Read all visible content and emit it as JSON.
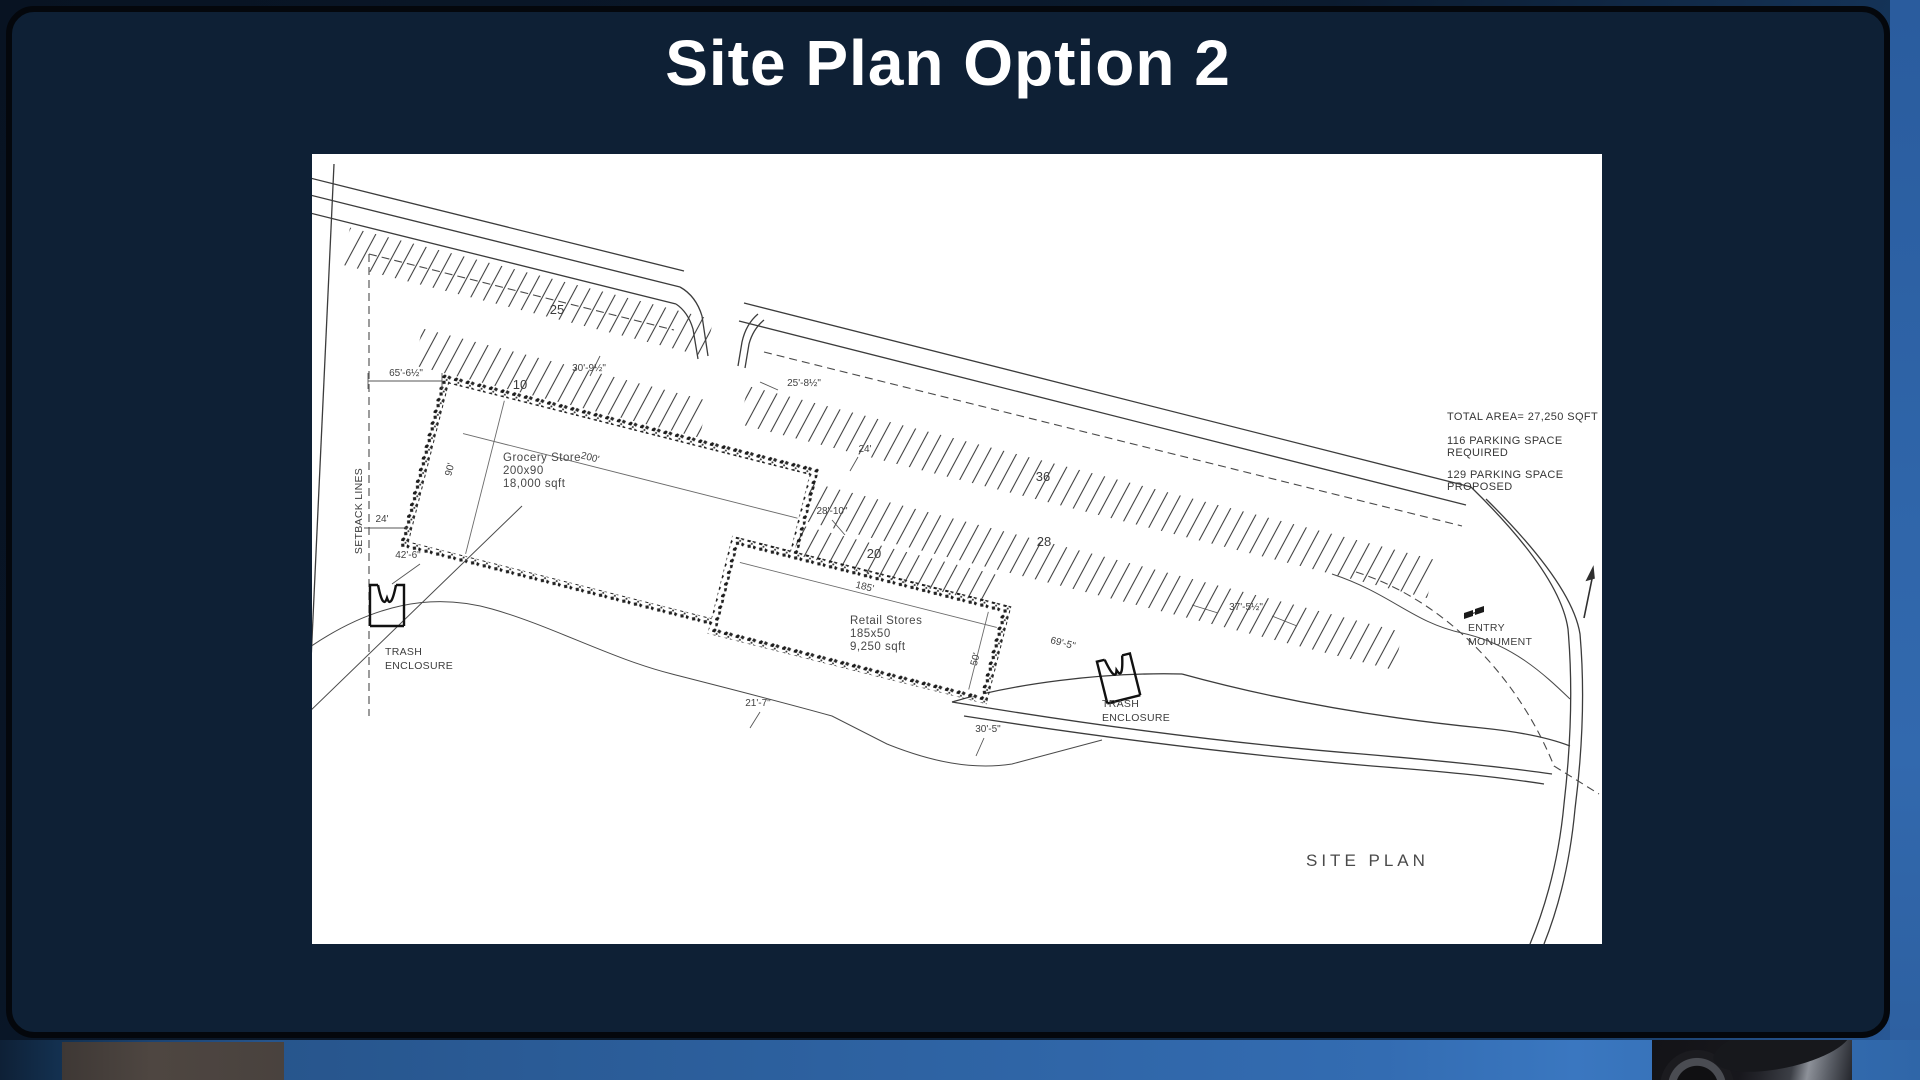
{
  "slide": {
    "title": "Site Plan Option 2"
  },
  "plan": {
    "notes": {
      "total_area": "TOTAL AREA= 27,250 SQFT",
      "required_line1": "116 PARKING SPACE",
      "required_line2": "REQUIRED",
      "proposed_line1": "129 PARKING SPACE",
      "proposed_line2": "PROPOSED"
    },
    "buildings": {
      "grocery": {
        "line1": "Grocery Store",
        "line2": "200x90",
        "line3": "18,000 sqft"
      },
      "retail": {
        "line1": "Retail Stores",
        "line2": "185x50",
        "line3": "9,250 sqft"
      }
    },
    "labels": {
      "site_plan": "SITE PLAN",
      "setback_lines": "SETBACK LINES",
      "trash_line1": "TRASH",
      "trash_line2": "ENCLOSURE",
      "entry_line1": "ENTRY",
      "entry_line2": "MONUMENT"
    },
    "parking_counts": {
      "row25": "25",
      "row10": "10",
      "row36": "36",
      "row28": "28",
      "row20": "20"
    },
    "dimensions": {
      "d65": "65'-6½\"",
      "d24a": "24'",
      "d42": "42'-6\"",
      "d30_9": "30'-9½\"",
      "d25_8": "25'-8½\"",
      "d24b": "24'",
      "d28_10": "28'-10\"",
      "d200": "200'",
      "d90": "90'",
      "d185": "185'",
      "d50": "50'",
      "d69_5": "69'-5\"",
      "d37_5": "37'-5½\"",
      "d21_7": "21'-7\"",
      "d30_5": "30'-5\""
    }
  }
}
